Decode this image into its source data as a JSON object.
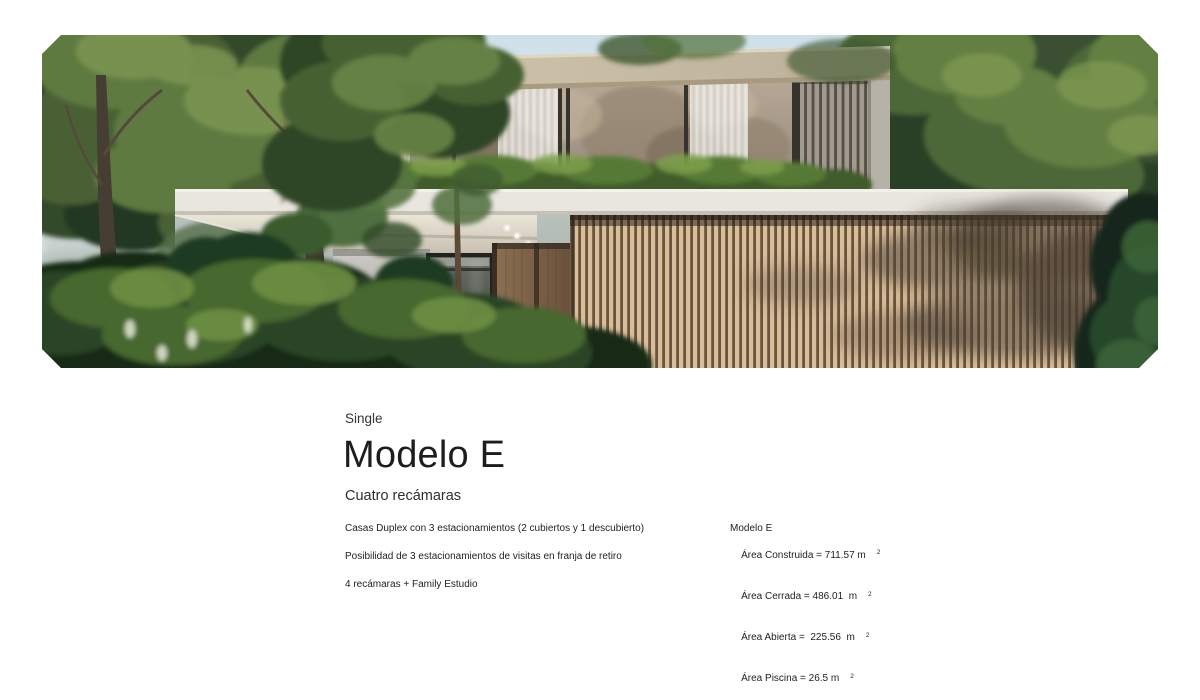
{
  "page": {
    "background": "#ffffff"
  },
  "hero": {
    "description": "Photorealistic rendering of a modern two-story duplex house with wood slat facade, full-height glass, white roof slab and lush tropical trees",
    "colors": {
      "sky": "#cfe0ea",
      "slat_light": "#d8bd99",
      "slat_gap": "#6b543e",
      "fascia_wood": "#c8bda6",
      "white_slab": "#e9e6e0",
      "foliage_dark": "#182a19",
      "foliage_light": "#6d8f43"
    }
  },
  "intro": {
    "eyebrow": "Single",
    "title": "Modelo E",
    "subtitle": "Cuatro recámaras"
  },
  "features": [
    "Casas Duplex con 3 estacionamientos (2 cubiertos y 1 descubierto)",
    "Posibilidad de 3 estacionamientos de visitas en franja de retiro",
    "4 recámaras + Family Estudio"
  ],
  "specs": {
    "model": "Modelo E",
    "areas": [
      {
        "text": "Área Construida = 711.57 m",
        "sup": "2"
      },
      {
        "text": "Área Cerrada = 486.01  m",
        "sup": "2"
      },
      {
        "text": "Área Abierta =  225.56  m",
        "sup": "2"
      },
      {
        "text": "Área Piscina = 26.5 m",
        "sup": "2"
      }
    ]
  }
}
